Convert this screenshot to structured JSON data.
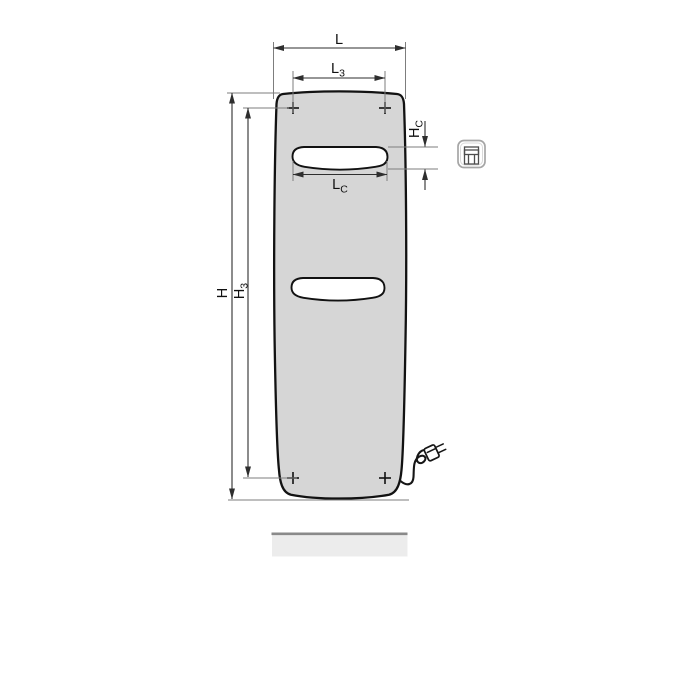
{
  "drawing": {
    "dimension_labels": {
      "L": {
        "main": "L",
        "sub": ""
      },
      "L3": {
        "main": "L",
        "sub": "3"
      },
      "Lc": {
        "main": "L",
        "sub": "C"
      },
      "H": {
        "main": "H",
        "sub": ""
      },
      "H3": {
        "main": "H",
        "sub": "3"
      },
      "Hc": {
        "main": "H",
        "sub": "C"
      }
    },
    "colors": {
      "radiator_fill": "#d6d6d6",
      "slot_fill": "#ffffff",
      "outline": "#121212",
      "dimension_line": "#2e2e2e",
      "extension_line": "#7d7d7d",
      "floor_fill": "#ececec",
      "floor_edge": "#8a8a8a",
      "icon_frame": "#a6a6a6",
      "icon_glyph": "#4d4d4d"
    }
  }
}
